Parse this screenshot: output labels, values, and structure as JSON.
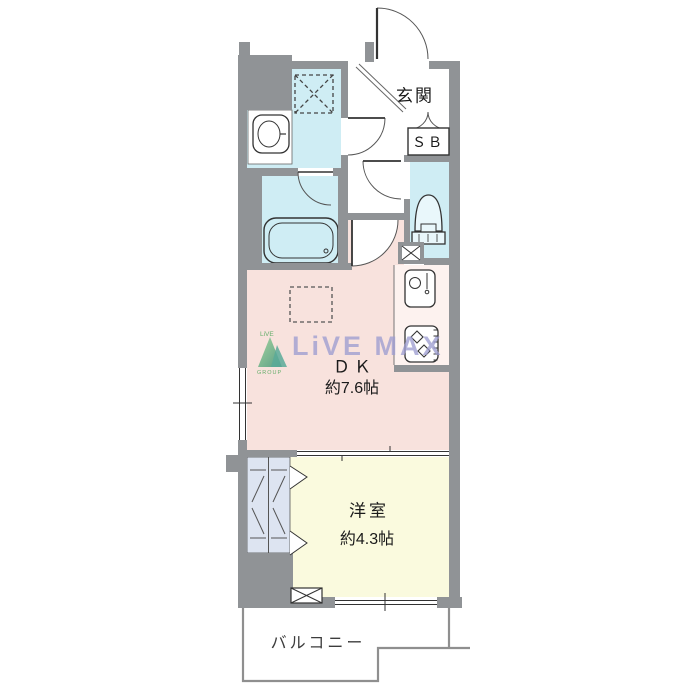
{
  "floorplan": {
    "rooms": {
      "entrance": {
        "label": "玄関"
      },
      "shoe_box": {
        "label": "ＳＢ"
      },
      "dining_kitchen": {
        "label": "ＤＫ",
        "size": "約7.6帖"
      },
      "western_room": {
        "label": "洋室",
        "size": "約4.3帖"
      },
      "balcony": {
        "label": "バルコニー"
      }
    },
    "watermark": {
      "brand": "LiVE MAX",
      "logo_top": "LiVE",
      "logo_bottom": "GROUP"
    },
    "fixtures": [
      "washing-machine-pan-icon",
      "washbasin-icon",
      "bathtub-icon",
      "toilet-icon",
      "kitchen-sink-icon",
      "gas-stove-icon",
      "refrigerator-space-dashed-box",
      "pipe-space-x-icon",
      "closet-hanger-icon"
    ],
    "colors": {
      "wall": "#909396",
      "water_rooms": "#cfedf4",
      "dining_kitchen": "#f8e2dd",
      "western_room": "#fafade",
      "closet": "#dde4f1",
      "kitchen_counter": "#fdf2ef",
      "watermark_text": "#9e9ed1",
      "logo_green": "#3da04b",
      "line": "#333333"
    }
  }
}
